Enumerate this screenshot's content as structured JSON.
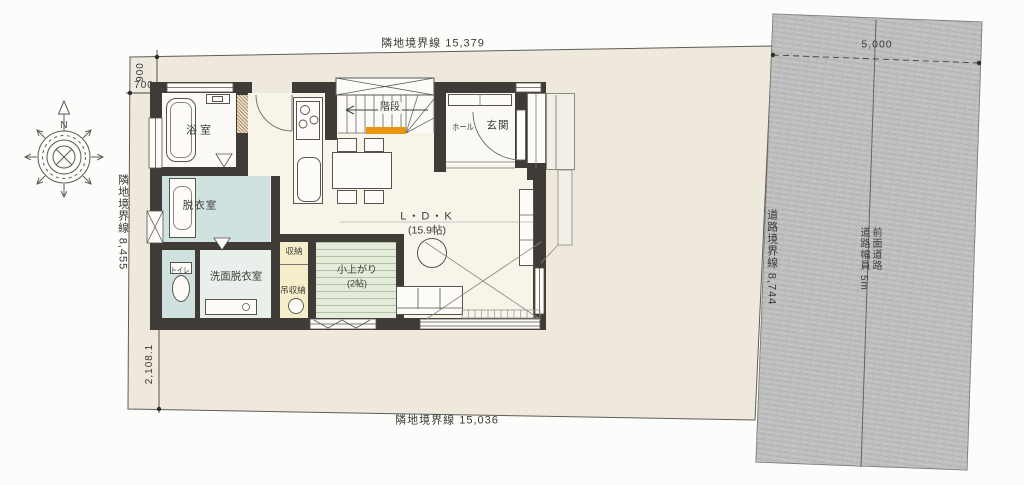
{
  "site": {
    "boundary_top": "隣地境界線 15,379",
    "boundary_bottom": "隣地境界線 15,036",
    "boundary_left": "隣地境界線 8,455",
    "dim_top_vertical": "900",
    "dim_top_horizontal": "700",
    "dim_bottom_vertical": "2,108.1"
  },
  "road": {
    "boundary": "道路境界線 8,744",
    "front_road": "前面道路",
    "width": "道路幅員 5m",
    "dim_width": "5,000"
  },
  "compass": {
    "north": "N"
  },
  "rooms": {
    "bath": "浴室",
    "dressing": "脱衣室",
    "toilet": "トイレ",
    "washroom": "洗面脱衣室",
    "storage": "収納",
    "hanging_storage": "吊収納",
    "tatami": "小上がり",
    "tatami_size": "(2帖)",
    "ldk": "L・D・K",
    "ldk_size": "(15.9帖)",
    "stairs": "階段",
    "hall": "ホール",
    "entrance": "玄関"
  },
  "colors": {
    "site_fill": "#efe9dd",
    "road_fill": "#bdbdbd",
    "wall": "#3f3b37",
    "wet_area_blue": "#cfe2e0",
    "storage_yellow": "#f6edca",
    "tatami_green": "#e4ebda",
    "stair_highlight": "#e8960f"
  }
}
